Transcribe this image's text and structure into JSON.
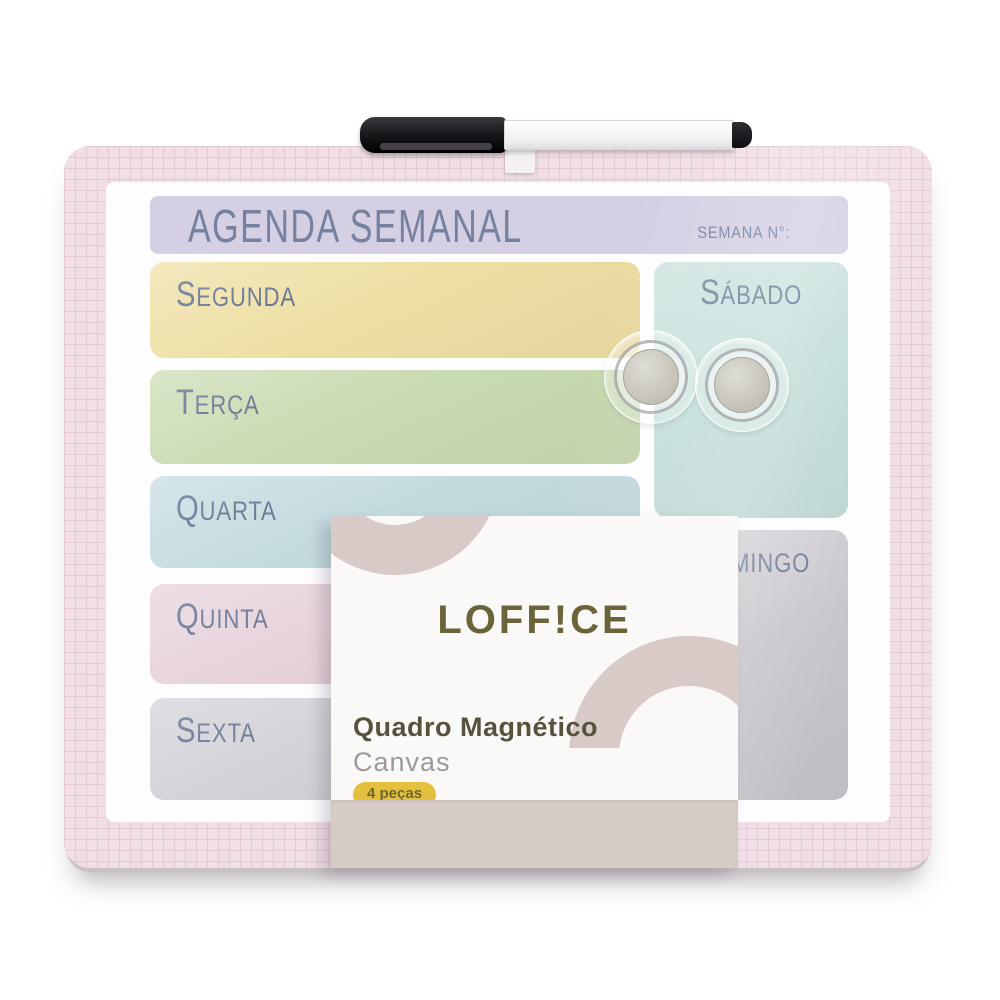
{
  "board": {
    "title": "AGENDA SEMANAL",
    "week_field_label": "SEMANA N°:",
    "title_bar_bg": "#d4cfe3",
    "title_text_color": "#75819f",
    "day_label_color": "#5c6a8b",
    "days": [
      {
        "label": "Segunda",
        "color": "#eedfa3"
      },
      {
        "label": "Terça",
        "color": "#c9dbb1"
      },
      {
        "label": "Quarta",
        "color": "#c3dbdf"
      },
      {
        "label": "Quinta",
        "color": "#e6d1da"
      },
      {
        "label": "Sexta",
        "color": "#d1d0d5"
      },
      {
        "label": "Sábado",
        "color": "#c2ded9"
      },
      {
        "label": "Domingo",
        "color": "#c8c6cc"
      }
    ],
    "border_pink": "#f1dee6",
    "grid_line_color": "#e3c8d4"
  },
  "card": {
    "brand": "LOFF!CE",
    "brand_color": "#6a6438",
    "product_name": "Quadro Magnético",
    "product_name_color": "#56523d",
    "product_line": "Canvas",
    "product_line_color": "#9b9a9a",
    "badge": "4 peças",
    "badge_bg": "#e5c03f",
    "badge_text_color": "#6d672f",
    "arc_color": "#d8cbc7",
    "band_color": "#d7ccc6"
  },
  "accessories": {
    "marker_count": 1,
    "magnet_count": 2
  }
}
